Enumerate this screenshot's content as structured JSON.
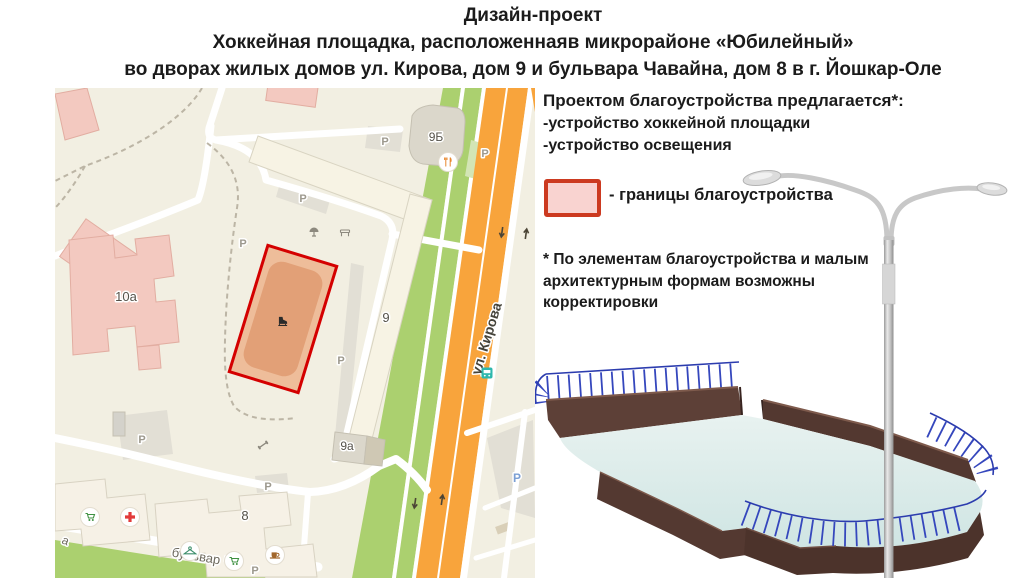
{
  "title": {
    "line1": "Дизайн-проект",
    "line2": "Хоккейная площадка, расположеннаяв микрорайоне «Юбилейный»",
    "line3": "во дворах жилых домов ул. Кирова, дом 9 и бульвара Чавайна, дом 8 в г. Йошкар-Оле"
  },
  "proposal": {
    "heading": "Проектом благоустройства предлагается*:",
    "item1": "-устройство хоккейной площадки",
    "item2": "-устройство освещения",
    "legend_label": "- границы благоустройства",
    "note_line1": "* По элементам благоустройства и малым",
    "note_line2": "архитектурным формам возможны",
    "note_line3": "корректировки"
  },
  "map": {
    "labels": {
      "building_9b": "9Б",
      "building_10a": "10а",
      "building_9": "9",
      "building_9a": "9а",
      "building_8": "8",
      "street_kirova": "ул. Кирова",
      "street_chavayna": "бульвар Ча",
      "street_fragment": "а",
      "parking": "Р"
    },
    "icons": [
      "restaurant-icon",
      "playground-icon",
      "bench-icon",
      "skate-icon",
      "dumbbell-icon",
      "grocery-cart-icon",
      "pharmacy-cross-icon",
      "clothing-hanger-icon",
      "cafe-cup-icon",
      "bus-stop-icon",
      "traffic-arrow-icon"
    ],
    "boundary": {
      "fill": "#eebd9a",
      "border": "#d40000"
    }
  },
  "render": {
    "subject": "hockey-rink-with-street-lighting",
    "ice_color": "#d9eae9",
    "boards_color": "#5d4037",
    "fence_color": "#3547bd",
    "lamp_color": "#c8c8c8"
  },
  "colors": {
    "page_bg": "#ffffff",
    "map_bg": "#f2efe2",
    "road_orange": "#f8a43c",
    "greenery": "#abd06f",
    "building_pink": "#f3c9c0",
    "building_cream": "#f7f3e4",
    "text": "#1b1b1b",
    "legend_swatch_fill": "#f9d3d0",
    "legend_swatch_border": "#cc3a20"
  }
}
